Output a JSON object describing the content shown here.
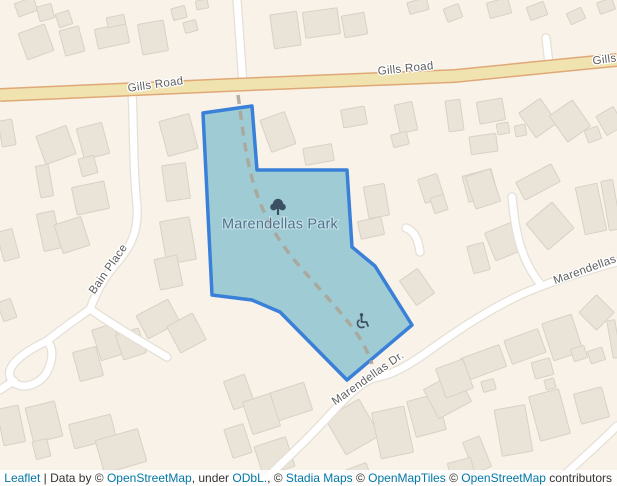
{
  "map": {
    "colors": {
      "background": "#f8f2e8",
      "building_fill": "#eae3d8",
      "building_stroke": "#d9d1c5",
      "road_fill": "#ffffff",
      "road_casing": "#e5dfd6",
      "major_road_fill": "#f0e3af",
      "major_road_casing": "#e0a877",
      "park_fill": "#9fccd4",
      "park_border": "#3a80d9",
      "footpath_dash": "#aba295",
      "road_label": "#5e5e5e",
      "park_label": "#4d7390",
      "icon": "#3c5063",
      "link": "#0078a8",
      "attribution_text": "#333333"
    },
    "park": {
      "name": "Marendellas Park",
      "label": {
        "x": 280,
        "y": 228.5
      },
      "polygon": [
        [
          203,
          113
        ],
        [
          252,
          106
        ],
        [
          257,
          170
        ],
        [
          347,
          170
        ],
        [
          352,
          247
        ],
        [
          375,
          266
        ],
        [
          412,
          325
        ],
        [
          347,
          380
        ],
        [
          280,
          312
        ],
        [
          252,
          300
        ],
        [
          212,
          295
        ]
      ],
      "footpath": "M238,95 C243,130 245,155 254,185 C263,215 276,238 296,262 C318,288 342,312 357,334 C365,346 369,355 372,364",
      "icons": {
        "tree-icon": {
          "x": 278,
          "y": 207
        },
        "wheelchair-icon": {
          "x": 363,
          "y": 321
        }
      }
    },
    "major_road": {
      "name": "Gills Road",
      "points": "0,95 230,85 455,76 575,64 617,60"
    },
    "minor_roads": [
      {
        "name": "north-lane",
        "d": "M237,0 L243,84"
      },
      {
        "name": "north-lane-east",
        "d": "M546,38 L549,64"
      },
      {
        "name": "bain-place",
        "d": "M132,91 C134,130 133,170 137,205 C139,235 128,250 115,265 C102,280 96,294 90,309"
      },
      {
        "name": "bain-place-east-branch",
        "d": "M90,309 C108,322 140,341 167,357"
      },
      {
        "name": "bain-place-loop-stem",
        "d": "M90,309 C78,318 60,330 47,341"
      },
      {
        "name": "cul-de-sac-loop",
        "d": "M47,341 C24,352 4,366 11,379 C19,392 40,385 47,372 C53,360 54,348 47,341 Z"
      },
      {
        "name": "loop-west-exit",
        "d": "M14,381 C9,384 4,387 0,390"
      },
      {
        "name": "marendellas-drive",
        "d": "M617,262 C592,269 565,277 542,286 C505,299 465,325 430,350 C405,368 390,375 378,377 C362,380 345,398 325,420 C305,442 283,462 262,482 L258,486"
      },
      {
        "name": "marendellas-spur",
        "d": "M512,197 C515,230 520,260 542,286"
      },
      {
        "name": "southeast-road",
        "d": "M552,486 C572,468 595,448 617,426"
      },
      {
        "name": "park-driveway",
        "d": "M406,228 C414,231 418,238 420,252"
      }
    ],
    "road_labels": [
      {
        "text": "Gills Road",
        "x": 156,
        "y": 88,
        "rotate": -8
      },
      {
        "text": "Gills Road",
        "x": 406,
        "y": 72,
        "rotate": -6
      },
      {
        "text": "Gills",
        "x": 605,
        "y": 63,
        "rotate": -8
      },
      {
        "text": "Bain Place",
        "x": 111,
        "y": 271,
        "rotate": -55
      },
      {
        "text": "Marendellas Dr.",
        "x": 370,
        "y": 381,
        "rotate": -35
      },
      {
        "text": "Marendellas",
        "x": 586,
        "y": 273,
        "rotate": -20
      }
    ],
    "buildings": [
      [
        16,
        0,
        20,
        14,
        -20
      ],
      [
        38,
        5,
        15,
        15,
        -15
      ],
      [
        57,
        12,
        14,
        14,
        -18
      ],
      [
        22,
        28,
        28,
        28,
        -20
      ],
      [
        62,
        28,
        20,
        26,
        -15
      ],
      [
        96,
        26,
        32,
        20,
        -12
      ],
      [
        107,
        16,
        18,
        10,
        -12
      ],
      [
        140,
        22,
        26,
        31,
        -10
      ],
      [
        172,
        7,
        14,
        12,
        -15
      ],
      [
        184,
        21,
        13,
        11,
        -15
      ],
      [
        196,
        0,
        12,
        9,
        -10
      ],
      [
        272,
        13,
        27,
        34,
        -8
      ],
      [
        304,
        10,
        35,
        26,
        -8
      ],
      [
        343,
        14,
        23,
        22,
        -10
      ],
      [
        342,
        108,
        24,
        18,
        -10
      ],
      [
        408,
        0,
        20,
        12,
        -15
      ],
      [
        445,
        6,
        16,
        14,
        -20
      ],
      [
        488,
        0,
        22,
        16,
        -15
      ],
      [
        528,
        4,
        18,
        14,
        -20
      ],
      [
        568,
        10,
        16,
        12,
        -25
      ],
      [
        598,
        0,
        16,
        12,
        -20
      ],
      [
        40,
        130,
        32,
        30,
        -20
      ],
      [
        80,
        125,
        26,
        32,
        -15
      ],
      [
        80,
        157,
        16,
        18,
        -15
      ],
      [
        74,
        184,
        33,
        28,
        -12
      ],
      [
        38,
        165,
        13,
        32,
        -10
      ],
      [
        40,
        212,
        18,
        38,
        -12
      ],
      [
        58,
        220,
        28,
        30,
        -18
      ],
      [
        163,
        117,
        31,
        36,
        -15
      ],
      [
        164,
        164,
        24,
        36,
        -8
      ],
      [
        163,
        219,
        30,
        43,
        -10
      ],
      [
        157,
        257,
        23,
        31,
        -12
      ],
      [
        0,
        120,
        14,
        26,
        -10
      ],
      [
        0,
        230,
        16,
        30,
        -15
      ],
      [
        265,
        115,
        26,
        34,
        -20
      ],
      [
        304,
        146,
        29,
        17,
        -10
      ],
      [
        397,
        103,
        18,
        29,
        -12
      ],
      [
        392,
        133,
        16,
        13,
        -15
      ],
      [
        447,
        100,
        15,
        31,
        -8
      ],
      [
        478,
        100,
        26,
        22,
        -10
      ],
      [
        497,
        123,
        12,
        11,
        -10
      ],
      [
        515,
        125,
        11,
        11,
        -10
      ],
      [
        525,
        103,
        26,
        30,
        -35
      ],
      [
        470,
        135,
        27,
        18,
        -8
      ],
      [
        556,
        105,
        28,
        32,
        -35
      ],
      [
        586,
        128,
        14,
        13,
        -20
      ],
      [
        600,
        110,
        20,
        22,
        -30
      ],
      [
        421,
        176,
        20,
        25,
        -18
      ],
      [
        465,
        172,
        30,
        27,
        -15
      ],
      [
        432,
        196,
        14,
        16,
        -18
      ],
      [
        533,
        209,
        34,
        34,
        -40
      ],
      [
        580,
        185,
        22,
        48,
        -12
      ],
      [
        605,
        180,
        12,
        50,
        -10
      ],
      [
        518,
        172,
        40,
        20,
        -28
      ],
      [
        470,
        172,
        26,
        34,
        -18
      ],
      [
        489,
        226,
        32,
        30,
        -22
      ],
      [
        470,
        244,
        17,
        28,
        -15
      ],
      [
        366,
        185,
        21,
        32,
        -10
      ],
      [
        359,
        219,
        24,
        18,
        -12
      ],
      [
        406,
        272,
        22,
        30,
        -35
      ],
      [
        140,
        306,
        36,
        26,
        -28
      ],
      [
        172,
        318,
        29,
        30,
        -28
      ],
      [
        96,
        326,
        23,
        32,
        -18
      ],
      [
        119,
        331,
        24,
        26,
        -18
      ],
      [
        76,
        349,
        24,
        30,
        -15
      ],
      [
        0,
        407,
        22,
        37,
        -12
      ],
      [
        29,
        404,
        30,
        36,
        -14
      ],
      [
        34,
        440,
        15,
        18,
        -14
      ],
      [
        71,
        419,
        43,
        25,
        -14
      ],
      [
        99,
        434,
        44,
        34,
        -16
      ],
      [
        0,
        300,
        14,
        20,
        -20
      ],
      [
        228,
        377,
        22,
        30,
        -20
      ],
      [
        273,
        387,
        36,
        29,
        -18
      ],
      [
        247,
        397,
        29,
        34,
        -18
      ],
      [
        228,
        426,
        20,
        30,
        -18
      ],
      [
        258,
        441,
        33,
        31,
        -18
      ],
      [
        333,
        406,
        39,
        42,
        -30
      ],
      [
        376,
        409,
        33,
        47,
        -12
      ],
      [
        411,
        397,
        31,
        37,
        -15
      ],
      [
        429,
        379,
        37,
        33,
        -28
      ],
      [
        347,
        466,
        22,
        14,
        -20
      ],
      [
        463,
        351,
        41,
        23,
        -20
      ],
      [
        507,
        334,
        36,
        25,
        -20
      ],
      [
        547,
        318,
        31,
        39,
        -18
      ],
      [
        572,
        347,
        14,
        13,
        -18
      ],
      [
        589,
        349,
        15,
        13,
        -18
      ],
      [
        584,
        300,
        25,
        25,
        -45
      ],
      [
        533,
        360,
        19,
        17,
        -15
      ],
      [
        545,
        379,
        10,
        10,
        -15
      ],
      [
        440,
        363,
        29,
        31,
        -20
      ],
      [
        482,
        380,
        13,
        11,
        -15
      ],
      [
        498,
        407,
        31,
        47,
        -10
      ],
      [
        534,
        392,
        31,
        46,
        -15
      ],
      [
        577,
        390,
        29,
        31,
        -15
      ],
      [
        468,
        438,
        18,
        33,
        -22
      ],
      [
        450,
        460,
        24,
        24,
        -15
      ],
      [
        610,
        320,
        8,
        38,
        -10
      ]
    ]
  },
  "attribution": {
    "parts": [
      {
        "text": "Leaflet",
        "link": true
      },
      {
        "text": " | Data by © ",
        "link": false
      },
      {
        "text": "OpenStreetMap",
        "link": true
      },
      {
        "text": ", under ",
        "link": false
      },
      {
        "text": "ODbL.",
        "link": true
      },
      {
        "text": ", © ",
        "link": false
      },
      {
        "text": "Stadia Maps",
        "link": true
      },
      {
        "text": " © ",
        "link": false
      },
      {
        "text": "OpenMapTiles",
        "link": true
      },
      {
        "text": " © ",
        "link": false
      },
      {
        "text": "OpenStreetMap",
        "link": true
      },
      {
        "text": " contributors",
        "link": false
      }
    ]
  }
}
